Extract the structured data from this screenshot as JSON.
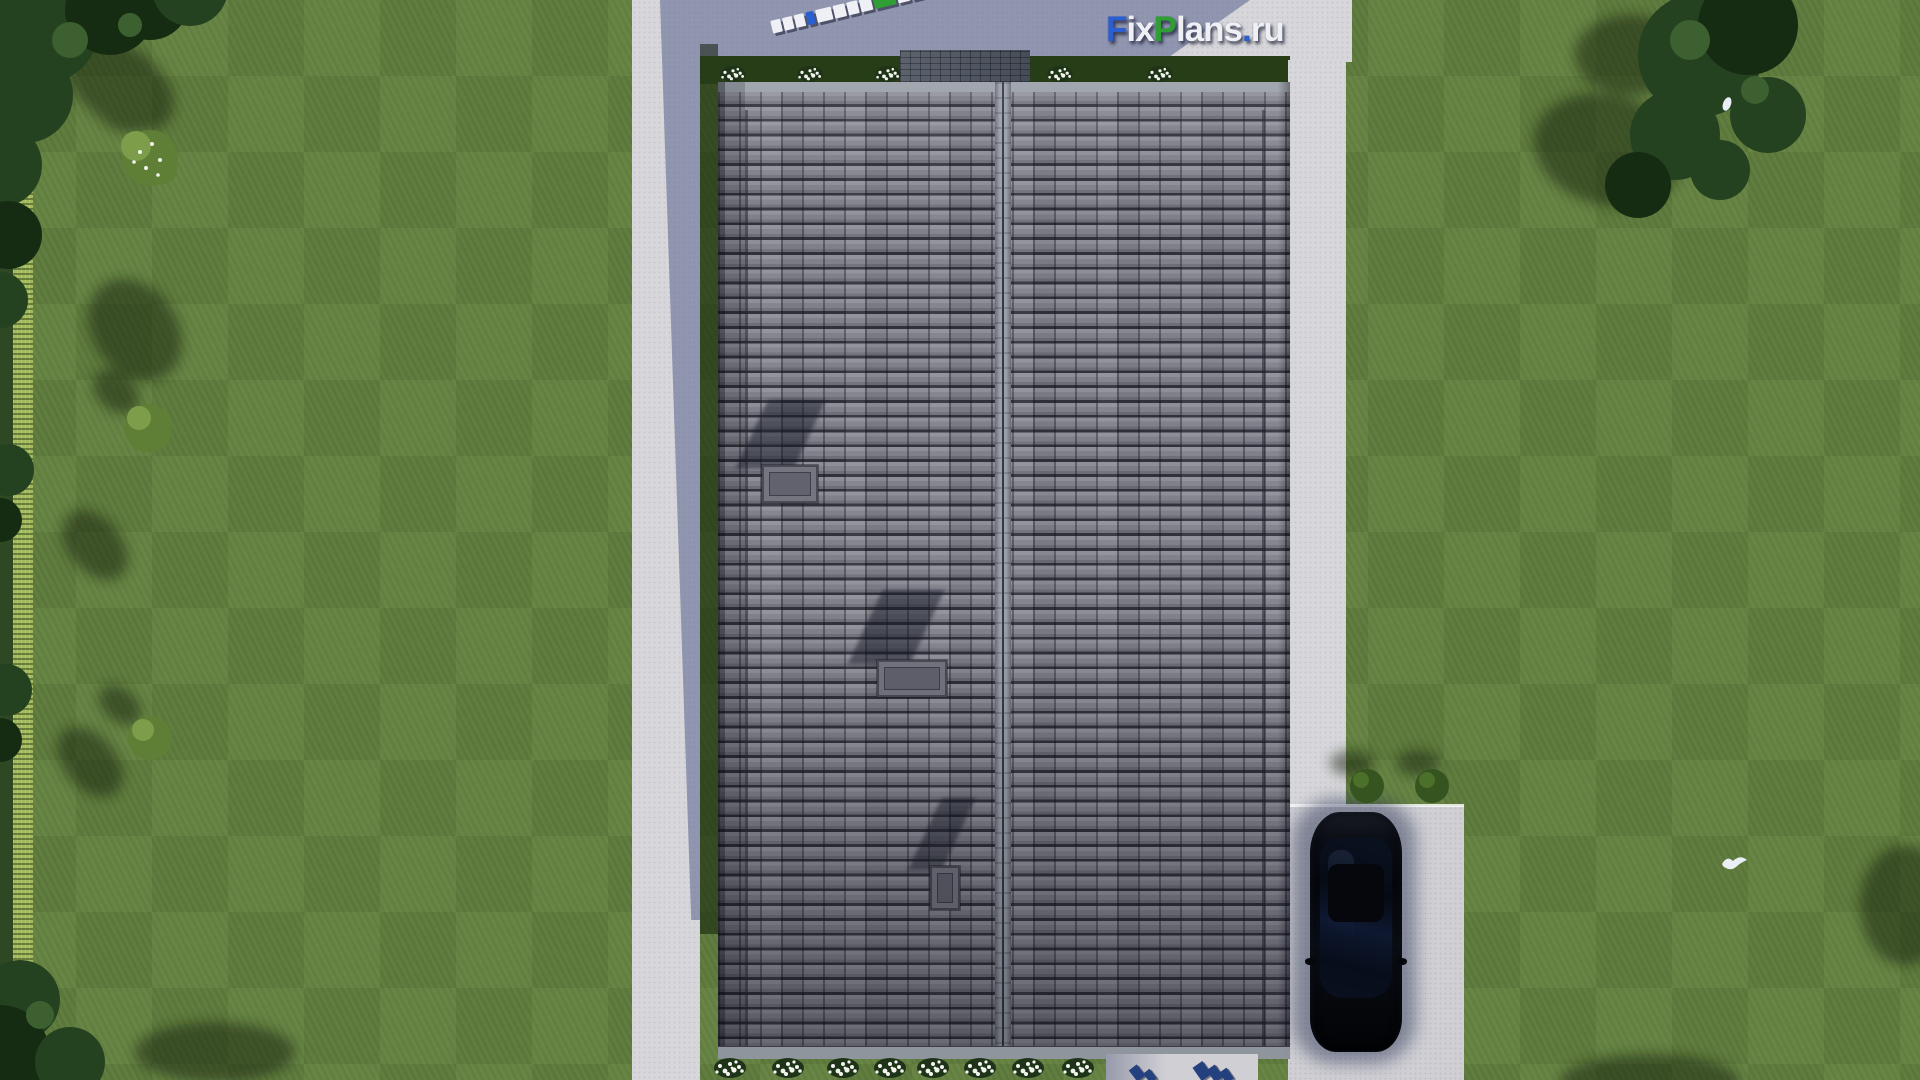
{
  "watermark": {
    "text": "FixPlans.ru",
    "segments": [
      {
        "t": "F",
        "c": "blue"
      },
      {
        "t": "ix",
        "c": "white"
      },
      {
        "t": "P",
        "c": "green"
      },
      {
        "t": "lans",
        "c": "white"
      },
      {
        "t": ".",
        "c": "blue"
      },
      {
        "t": "ru",
        "c": "white"
      }
    ]
  },
  "colors": {
    "lawn": "#63813f",
    "hedge": "#a3b95e",
    "border_strip": "#2d4823",
    "tree": "#24421f",
    "tree_light": "#3c6030",
    "cast_shadow": "#14240f",
    "pavement": "#d7d7db",
    "pavement_dark": "#cfcfd4",
    "shade_blue": "#8a90ad",
    "roof_light": "#8e8e98",
    "roof_mid": "#80808a",
    "roof_dark": "#31313b",
    "roof_edge": "#9aa0a8",
    "patio": "#4e5663",
    "car": "#0a0c11",
    "glass": "#0d1626",
    "logo_blue": "#2b5fd0",
    "logo_green": "#2f9e35",
    "logo_white": "#eef0f6",
    "flower": "#f2f4ee",
    "navy_block": "#24407e"
  },
  "ground_logo": {
    "blocks": [
      {
        "c": "white",
        "w": 10
      },
      {
        "c": "white",
        "w": 10
      },
      {
        "c": "white",
        "w": 10
      },
      {
        "c": "blue",
        "w": 8
      },
      {
        "c": "white",
        "w": 16
      },
      {
        "c": "white",
        "w": 12
      },
      {
        "c": "white",
        "w": 11
      },
      {
        "c": "white",
        "w": 12
      },
      {
        "c": "green",
        "w": 22
      },
      {
        "c": "white",
        "w": 12
      },
      {
        "c": "white",
        "w": 11
      },
      {
        "c": "green",
        "w": 8
      },
      {
        "c": "blue",
        "w": 24,
        "h": 20
      }
    ]
  },
  "bottom_blocks": [
    {
      "x": 1132,
      "y": 1066,
      "w": 10,
      "h": 14,
      "r": -38
    },
    {
      "x": 1146,
      "y": 1070,
      "w": 8,
      "h": 12,
      "r": -38
    },
    {
      "x": 1196,
      "y": 1063,
      "w": 12,
      "h": 16,
      "r": -35
    },
    {
      "x": 1210,
      "y": 1066,
      "w": 10,
      "h": 15,
      "r": -35
    },
    {
      "x": 1222,
      "y": 1069,
      "w": 9,
      "h": 13,
      "r": -35
    }
  ],
  "flower_beds": {
    "top_xs": [
      733,
      810,
      888,
      1060,
      1160
    ],
    "bottom_xs": [
      730,
      788,
      843,
      890,
      933,
      980,
      1028,
      1078
    ]
  }
}
